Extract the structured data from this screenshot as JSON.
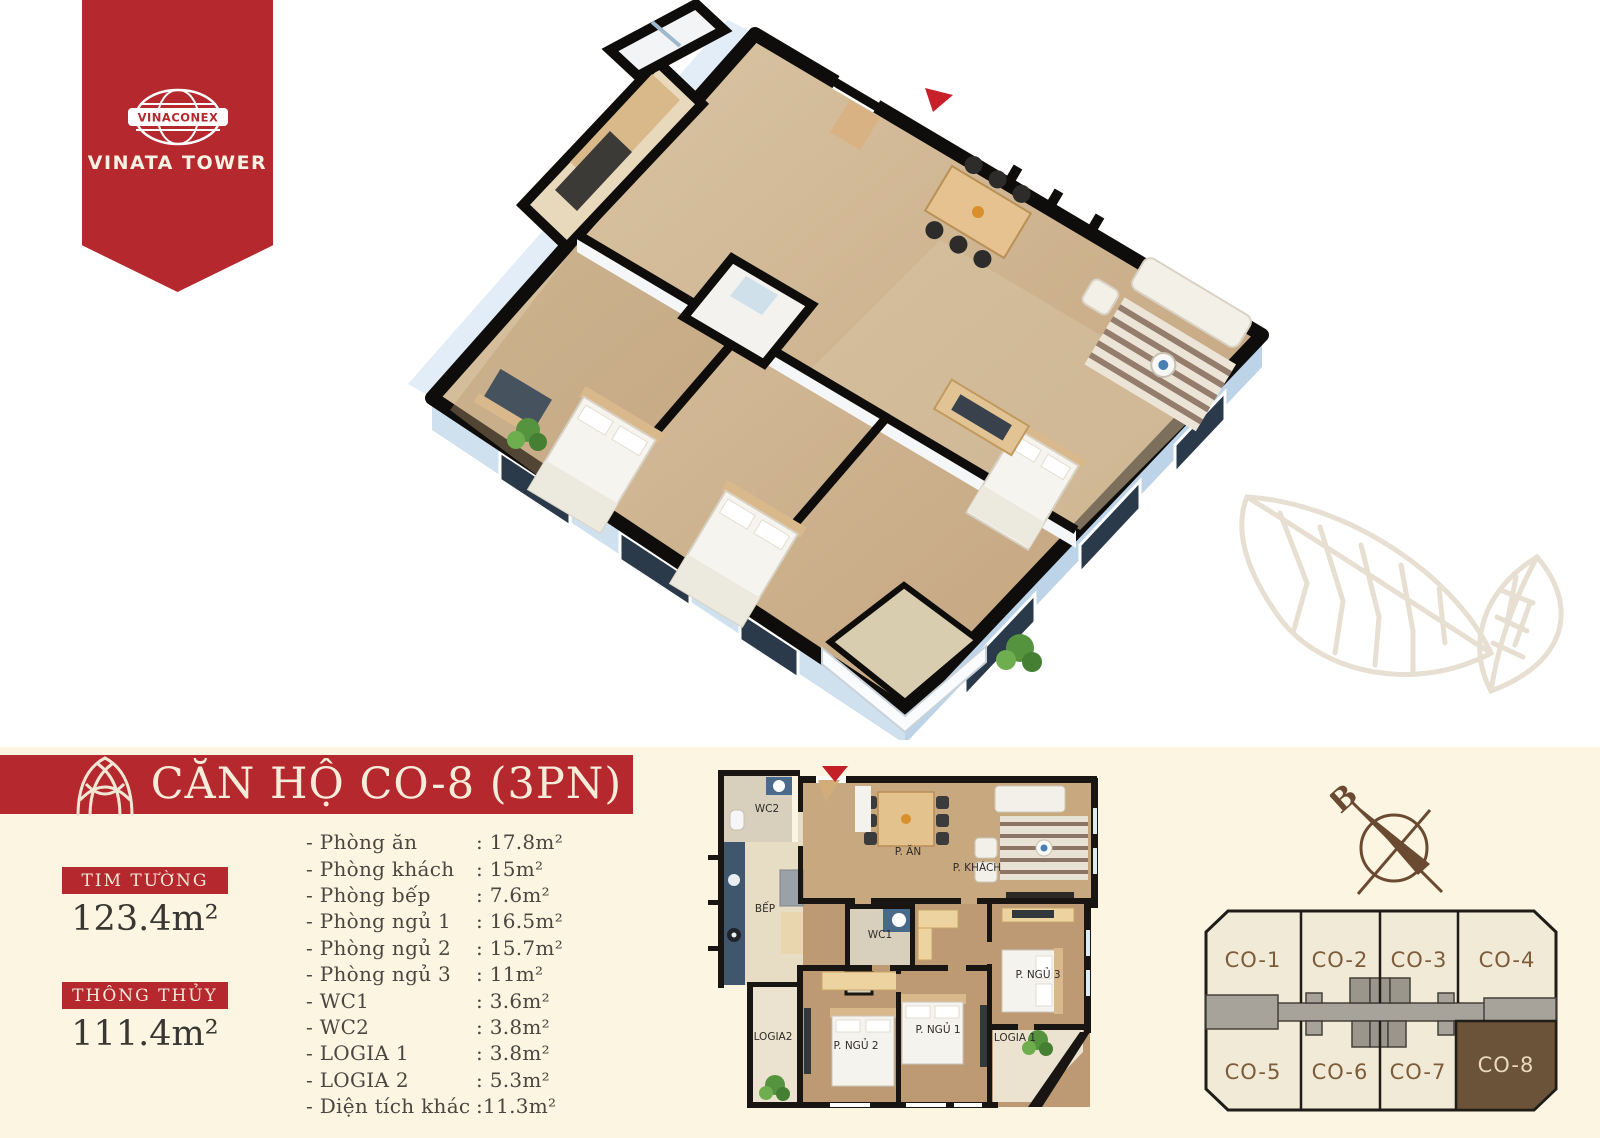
{
  "brand": {
    "logo_text": "VINACONEX",
    "project": "VINATA TOWER"
  },
  "header": {
    "title": "CĂN HỘ CO-8 (3PN)"
  },
  "stats": [
    {
      "label": "TIM TƯỜNG",
      "value": "123.4m²"
    },
    {
      "label": "THÔNG THỦY",
      "value": "111.4m²"
    }
  ],
  "rooms": [
    {
      "label": "- Phòng ăn",
      "value": ": 17.8m²"
    },
    {
      "label": "- Phòng khách",
      "value": ": 15m²"
    },
    {
      "label": "- Phòng bếp",
      "value": ": 7.6m²"
    },
    {
      "label": "- Phòng ngủ 1",
      "value": ": 16.5m²"
    },
    {
      "label": "- Phòng ngủ 2",
      "value": ": 15.7m²"
    },
    {
      "label": "- Phòng ngủ 3",
      "value": ": 11m²"
    },
    {
      "label": "- WC1",
      "value": ": 3.6m²"
    },
    {
      "label": "- WC2",
      "value": ": 3.8m²"
    },
    {
      "label": "- LOGIA 1",
      "value": ": 3.8m²"
    },
    {
      "label": "- LOGIA 2",
      "value": ": 5.3m²"
    },
    {
      "label": "- Diện tích khác",
      "value": ":11.3m²"
    }
  ],
  "plan2d": {
    "labels": {
      "wc2": "WC2",
      "bep": "BẾP",
      "an": "P. ĂN",
      "khach": "P. KHÁCH",
      "wc1": "WC1",
      "ngu2": "P. NGỦ 2",
      "ngu1": "P. NGỦ 1",
      "ngu3": "P. NGỦ 3",
      "logia2": "LOGIA2",
      "logia1": "LOGIA 1"
    }
  },
  "keyplan": {
    "units": [
      "CO-1",
      "CO-2",
      "CO-3",
      "CO-4",
      "CO-5",
      "CO-6",
      "CO-7",
      "CO-8"
    ],
    "highlighted_unit": "CO-8"
  },
  "compass": {
    "north_label": "B"
  },
  "colors": {
    "accent_red": "#b5282d",
    "cream_background": "#fbf5e2",
    "highlight_brown": "#6b5339",
    "unit_fill": "#f1ead6",
    "corridor_gray": "#a7a39a",
    "text_brown": "#7c5c3a"
  }
}
